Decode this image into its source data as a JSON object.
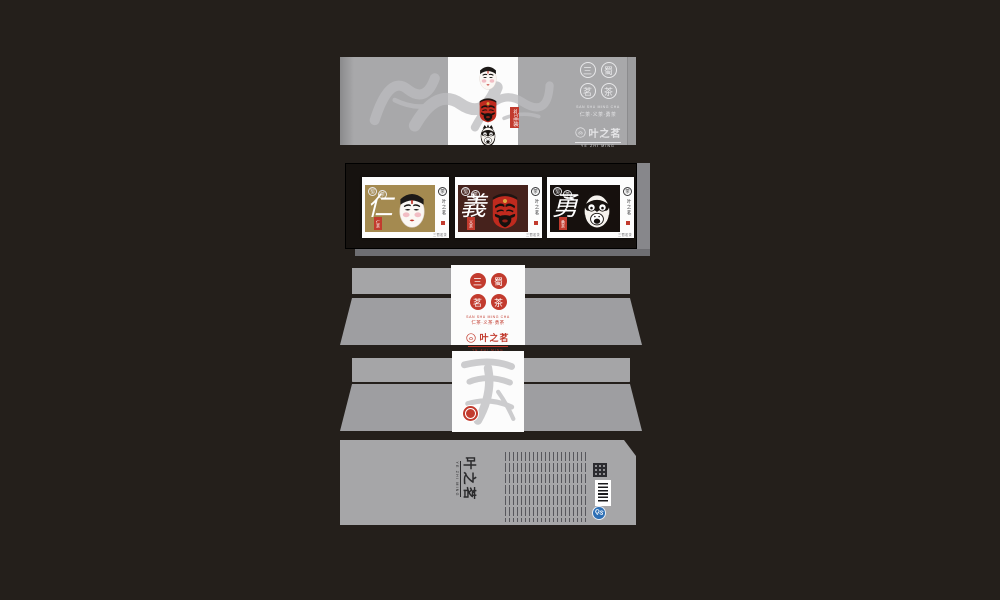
{
  "scene": {
    "background": "#241f1b",
    "panel_gray": "#a8a8aa",
    "accent_red": "#c23b2e",
    "tray_black": "#16120f"
  },
  "brand": {
    "logo_circles": [
      "三",
      "蜀",
      "茗",
      "茶"
    ],
    "tagline_en": "SAN SHU MING CHA",
    "tagline_cn": "仁茶·义茶·勇茶",
    "name": "叶之茗",
    "name_en": "YE ZHI MING"
  },
  "lid": {
    "gift_tag": "礼品装",
    "watermark_chars": "仁義勇",
    "masks": [
      "white-hero-face",
      "red-hero-face",
      "black-hero-face"
    ]
  },
  "tray": {
    "mini_circles": [
      "蜀",
      "茶"
    ],
    "side_circle": "茶",
    "side_micro": "三蜀茗茶",
    "cards": [
      {
        "virtue": "仁",
        "seal_label": "仁茶",
        "bg": "#a48a50",
        "face": "white-hero-face"
      },
      {
        "virtue": "義",
        "seal_label": "义茶",
        "bg": "#46221c",
        "face": "red-hero-face"
      },
      {
        "virtue": "勇",
        "seal_label": "勇茶",
        "bg": "#16100d",
        "face": "black-hero-face"
      }
    ]
  },
  "back": {
    "watermark_chars": "三英"
  },
  "bottom": {
    "qs_label": "QS"
  }
}
